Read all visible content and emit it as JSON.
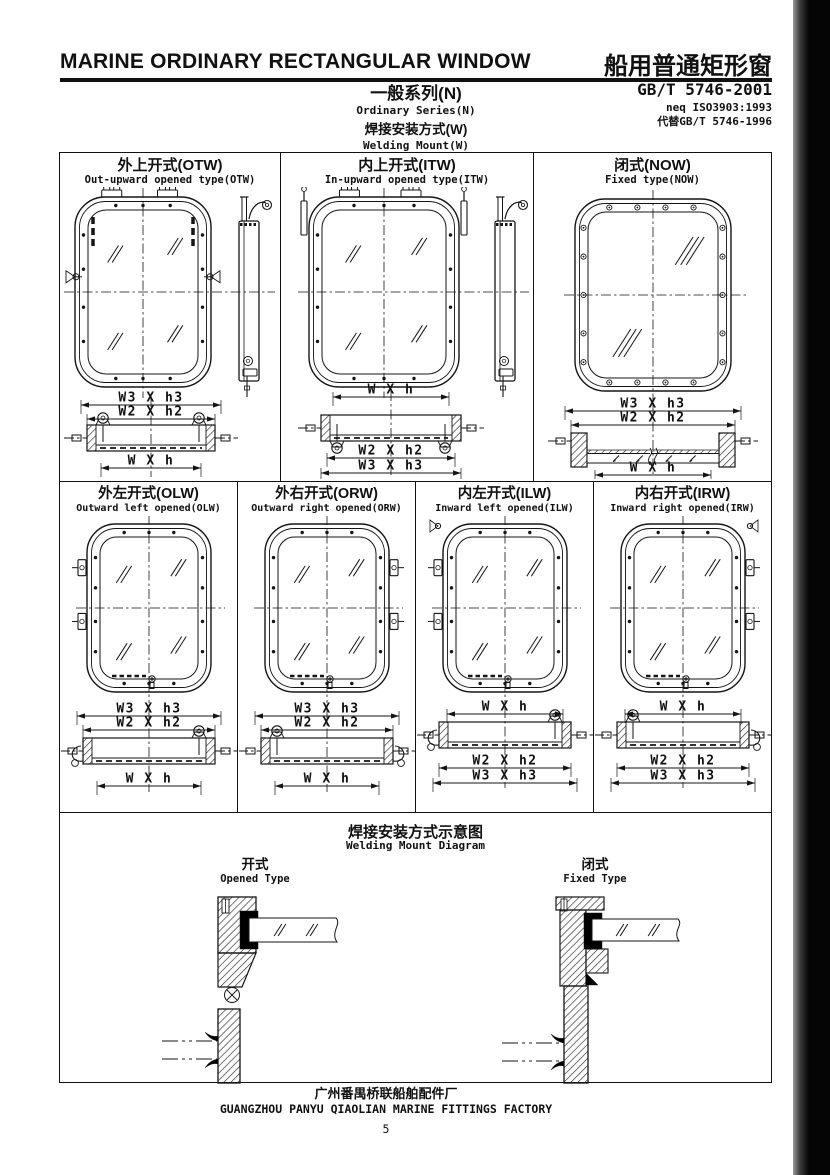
{
  "header": {
    "title_en": "MARINE ORDINARY RECTANGULAR WINDOW",
    "title_zh": "船用普通矩形窗",
    "series_zh": "一般系列(N)",
    "series_en": "Ordinary Series(N)",
    "mount_zh": "焊接安装方式(W)",
    "mount_en": "Welding Mount(W)",
    "standard": "GB/T 5746-2001",
    "standard_neq": "neq ISO3903:1993",
    "standard_replace": "代替GB/T 5746-1996"
  },
  "row1": [
    {
      "title_zh": "外上开式(OTW)",
      "title_en": "Out-upward opened type(OTW)",
      "dims_top": [
        "W3 X h3",
        "W2 X h2"
      ],
      "dims_bottom": [
        "W X h"
      ]
    },
    {
      "title_zh": "内上开式(ITW)",
      "title_en": "In-upward opened type(ITW)",
      "dims_top": [
        "W X h"
      ],
      "dims_bottom": [
        "W2 X h2",
        "W3 X h3"
      ]
    },
    {
      "title_zh": "闭式(NOW)",
      "title_en": "Fixed type(NOW)",
      "dims_top": [
        "W3 X h3",
        "W2 X h2"
      ],
      "dims_bottom": [
        "W X h"
      ]
    }
  ],
  "row2": [
    {
      "title_zh": "外左开式(OLW)",
      "title_en": "Outward left opened(OLW)",
      "dims_top": [
        "W3 X h3",
        "W2 X h2"
      ],
      "dims_bottom": [
        "W X h"
      ]
    },
    {
      "title_zh": "外右开式(ORW)",
      "title_en": "Outward right opened(ORW)",
      "dims_top": [
        "W3 X h3",
        "W2 X h2"
      ],
      "dims_bottom": [
        "W X h"
      ]
    },
    {
      "title_zh": "内左开式(ILW)",
      "title_en": "Inward left opened(ILW)",
      "dims_top": [
        "W X h"
      ],
      "dims_bottom": [
        "W2 X h2",
        "W3 X h3"
      ]
    },
    {
      "title_zh": "内右开式(IRW)",
      "title_en": "Inward right opened(IRW)",
      "dims_top": [
        "W X h"
      ],
      "dims_bottom": [
        "W2 X h2",
        "W3 X h3"
      ]
    }
  ],
  "welding": {
    "title_zh": "焊接安装方式示意图",
    "title_en": "Welding Mount Diagram",
    "opened_zh": "开式",
    "opened_en": "Opened Type",
    "fixed_zh": "闭式",
    "fixed_en": "Fixed Type"
  },
  "footer": {
    "factory_zh": "广州番禺桥联船舶配件厂",
    "factory_en": "GUANGZHOU PANYU QIAOLIAN MARINE FITTINGS FACTORY",
    "page_number": "5"
  }
}
